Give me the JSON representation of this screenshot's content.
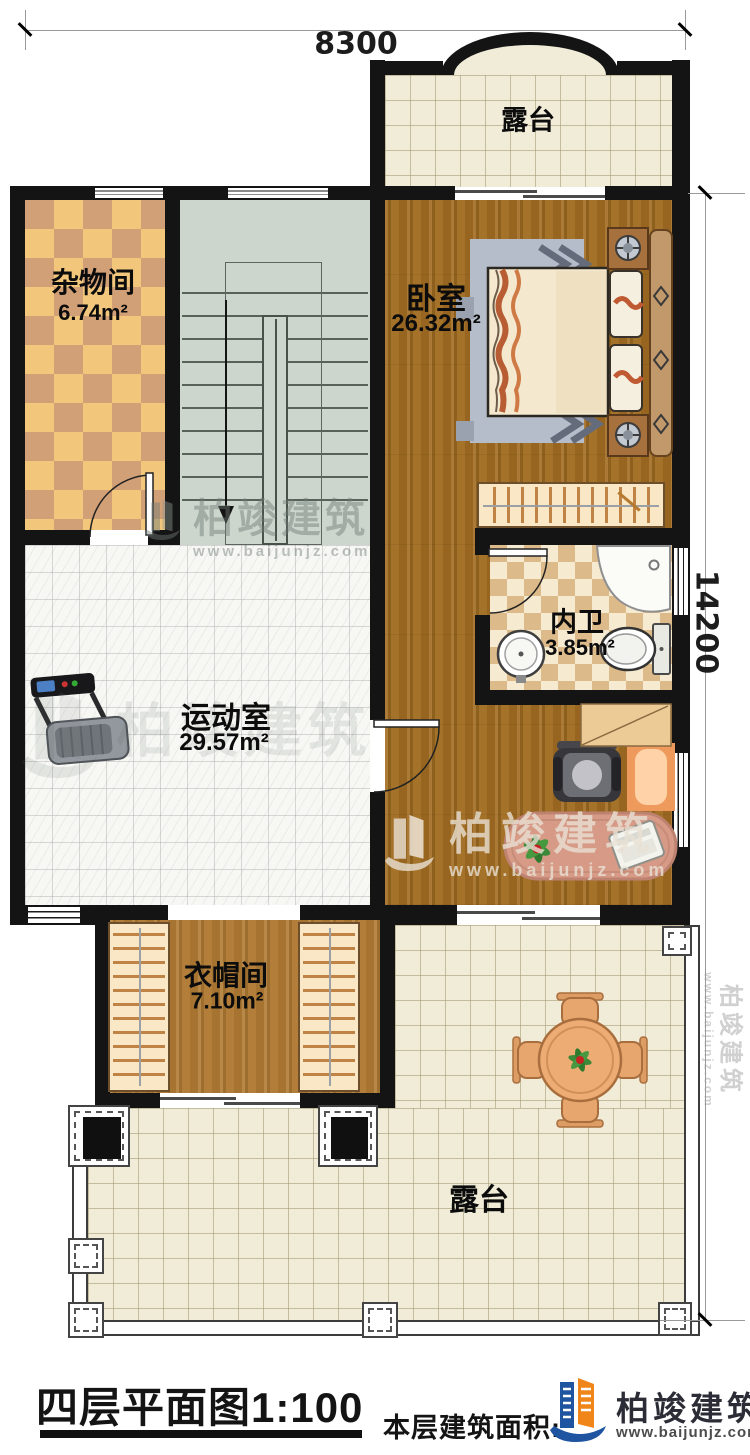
{
  "dimensions": {
    "top_width": "8300",
    "right_height": "14200"
  },
  "rooms": {
    "terrace_top": {
      "name": "露台"
    },
    "storage": {
      "name": "杂物间",
      "area": "6.74m²"
    },
    "bedroom": {
      "name": "卧室",
      "area": "26.32m²"
    },
    "bathroom": {
      "name": "内卫",
      "area": "3.85m²"
    },
    "gym": {
      "name": "运动室",
      "area": "29.57m²"
    },
    "cloakroom": {
      "name": "衣帽间",
      "area": "7.10m²"
    },
    "terrace_bottom": {
      "name": "露台"
    }
  },
  "footer": {
    "title": "四层平面图1:100",
    "area_label": "本层建筑面积:"
  },
  "brand": {
    "name": "柏竣建筑",
    "url": "www.baijunjz.com"
  },
  "colors": {
    "wall": "#141414",
    "wood": "#a26d22",
    "checker_light": "#f2c77c",
    "checker_dark": "#d2a077",
    "stair": "#ccd6cc",
    "terrace_tile": "#f1ecd8",
    "brand_blue": "#1e54a0",
    "brand_orange": "#f08519"
  }
}
